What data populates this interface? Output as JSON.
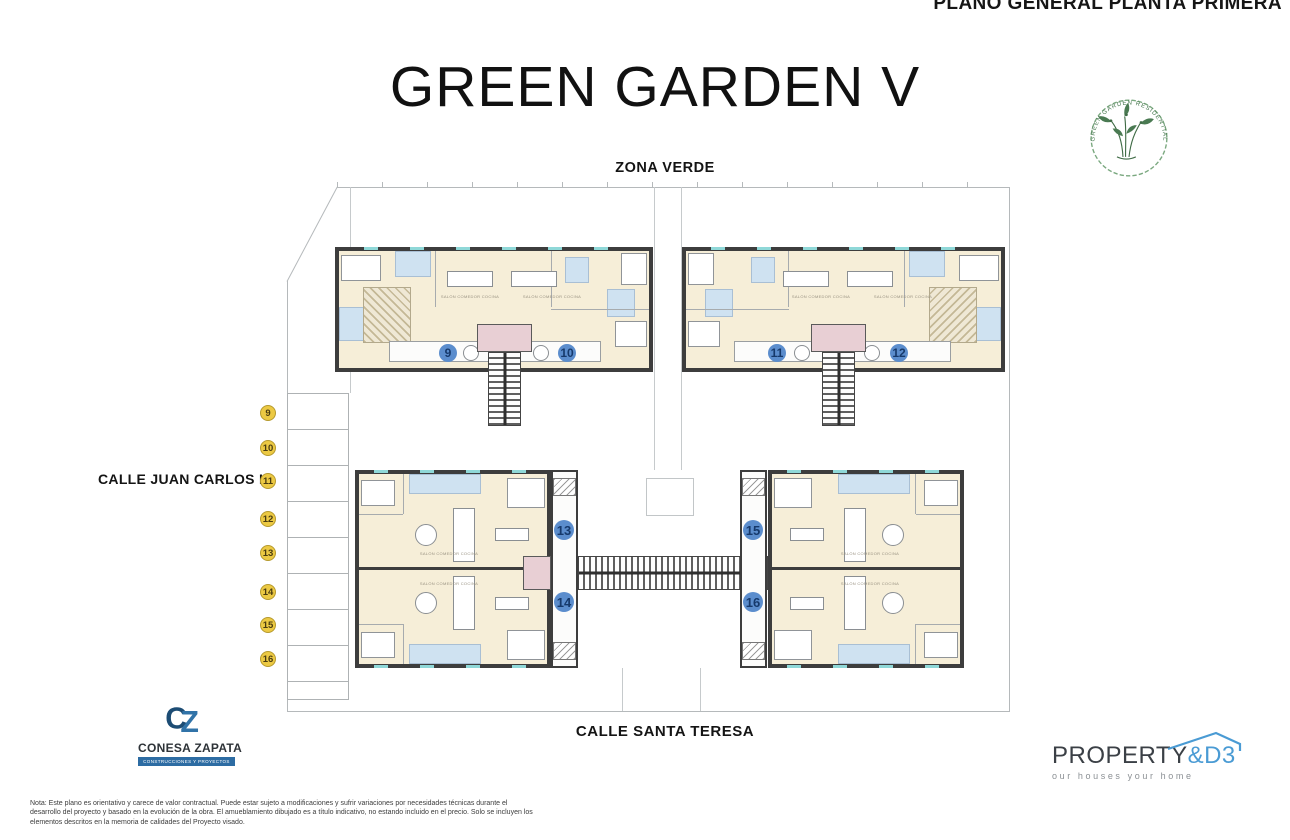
{
  "header": {
    "sheet_title": "PLANO GENERAL PLANTA PRIMERA",
    "project_title": "GREEN GARDEN V"
  },
  "labels": {
    "top_street": "ZONA VERDE",
    "left_street": "CALLE JUAN CARLOS I",
    "bottom_street": "CALLE SANTA TERESA"
  },
  "stamp": {
    "arc_text": "GREEN GARDEN RESIDENTIAL"
  },
  "plan": {
    "units": [
      "9",
      "10",
      "11",
      "12",
      "13",
      "14",
      "15",
      "16"
    ],
    "parking_labels": [
      "9",
      "10",
      "11",
      "12",
      "13",
      "14",
      "15",
      "16"
    ],
    "room_labels": {
      "living": "SALÓN COMEDOR COCINA"
    }
  },
  "logos": {
    "conesa_zapata": {
      "monogram_c": "C",
      "monogram_z": "Z",
      "name": "CONESA ZAPATA",
      "tagline": "CONSTRUCCIONES Y PROYECTOS"
    },
    "property_d3": {
      "brand_dark": "PROPERTY",
      "brand_accent": "&D3",
      "tagline": "our houses your home"
    }
  },
  "footnote": "Nota: Este plano es orientativo y carece de valor contractual. Puede estar sujeto a modificaciones y sufrir variaciones por necesidades técnicas durante el desarrollo del proyecto y basado en la evolución de la obra. El amueblamiento dibujado es a título indicativo, no estando incluido en el precio. Solo se incluyen los elementos descritos en la memoria de calidades del Proyecto visado.",
  "colors": {
    "room_cream": "#f6eed8",
    "bath_blue": "#cfe2f1",
    "wall_dark": "#3d3d3d",
    "landing_pink": "#e8cfd4",
    "unit_circle_blue": "#5b8dcd",
    "unit_number_navy": "#16396b",
    "parking_yellow": "#ecc943",
    "stamp_green": "#4a7a52",
    "brand_blue": "#2d6ca3",
    "accent_blue": "#4a9bd4",
    "window_teal": "#8fd8d8"
  }
}
